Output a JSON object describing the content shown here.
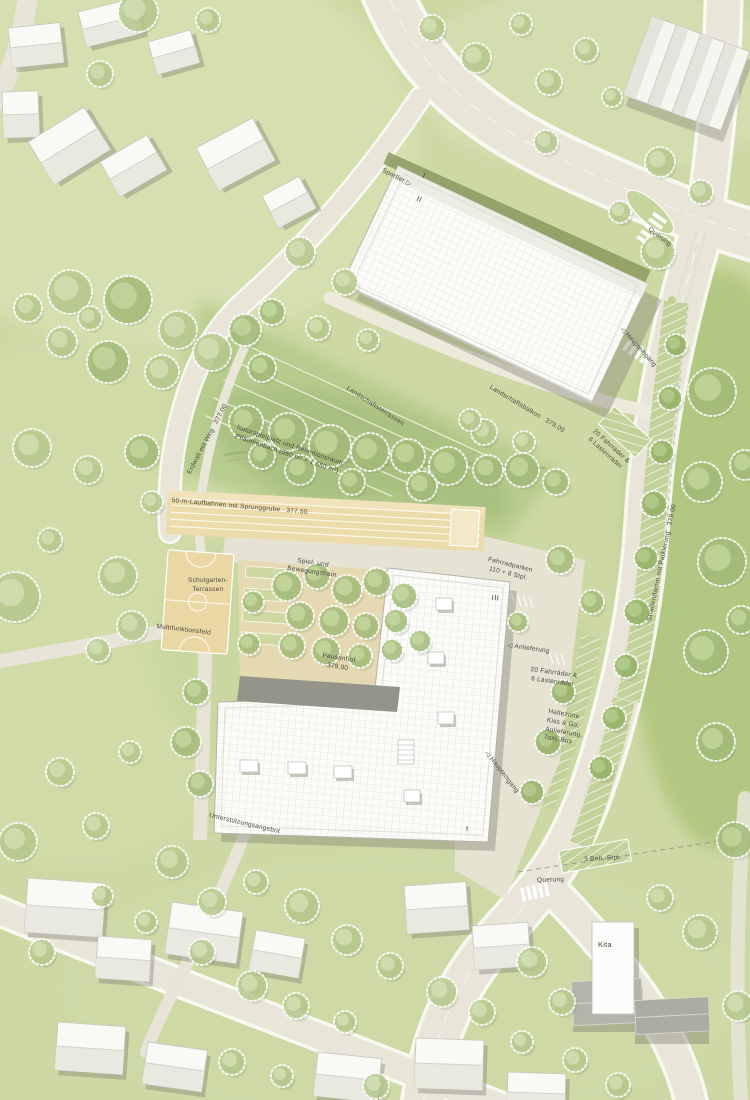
{
  "plan": {
    "labels": {
      "sportler": "Sportler ▷",
      "querung_top": "Querung",
      "haupteingang_top": "◁ Haupteingang",
      "landschaftsterrassen": "Landschaftsterrassen",
      "landschaftsbalkon": "Landschaftsbalkon   379.00",
      "erdwall": "Erdwall mit Weg   377.00",
      "naturspielplatz": "Naturspielplatz und Retentionsraum\nPflaumenbach (550 m² + 1.650 m²)",
      "laufbahnen": "50-m-Laufbahnen mit Sprunggrube   377.50",
      "schulgarten": "Schulgarten-\nTerrassen",
      "multifunktionsfeld": "Multifunktionsfeld",
      "spielhain": "Spiel- und\nBewegungshain",
      "fahrradparken": "Fahrradparken\n110 + 8 Stpl.",
      "pausenhof": "Pausenhof\n379.00",
      "anlieferung": "◁ Anlieferung",
      "fahrrad_schule": "20 Fahrräder &\n6 Lastenräder",
      "haltezone": "Haltezone\nKiss & Go,\nAnlieferung,\nTaxi, Bus",
      "haupteingang_sued": "◁ Haupteingang",
      "unterstuetzung": "Unterstützungsangebot",
      "beh_stpl": "3 Beh.-Stpl.",
      "querung_sued": "Querung",
      "kita": "Kita",
      "strassendamm": "Straßendamm mit Parkierung   379.00",
      "fahrrad_strasse": "20 Fahrräder &\n6 Lastenräder"
    },
    "storeys": {
      "halle_i": "I",
      "halle_ii": "II",
      "schule_iii": "III",
      "schule_i": "I"
    },
    "levels": {
      "landschaftsbalkon": "379.00",
      "erdwall_weg": "377.00",
      "laufbahn": "377.50",
      "pausenhof": "379.00",
      "strassendamm": "379.00"
    },
    "colors": {
      "grass": "#cdd8a4",
      "grass_dark": "#a6bf7e",
      "road": "#e9e6d9",
      "sport_surface": "#e9d7a4",
      "building_roof": "#fbfbf8",
      "roof_band_dark": "#94948b",
      "tree": "#a3bc79",
      "street_tree": "#93b163",
      "text": "#4b4b41"
    }
  }
}
